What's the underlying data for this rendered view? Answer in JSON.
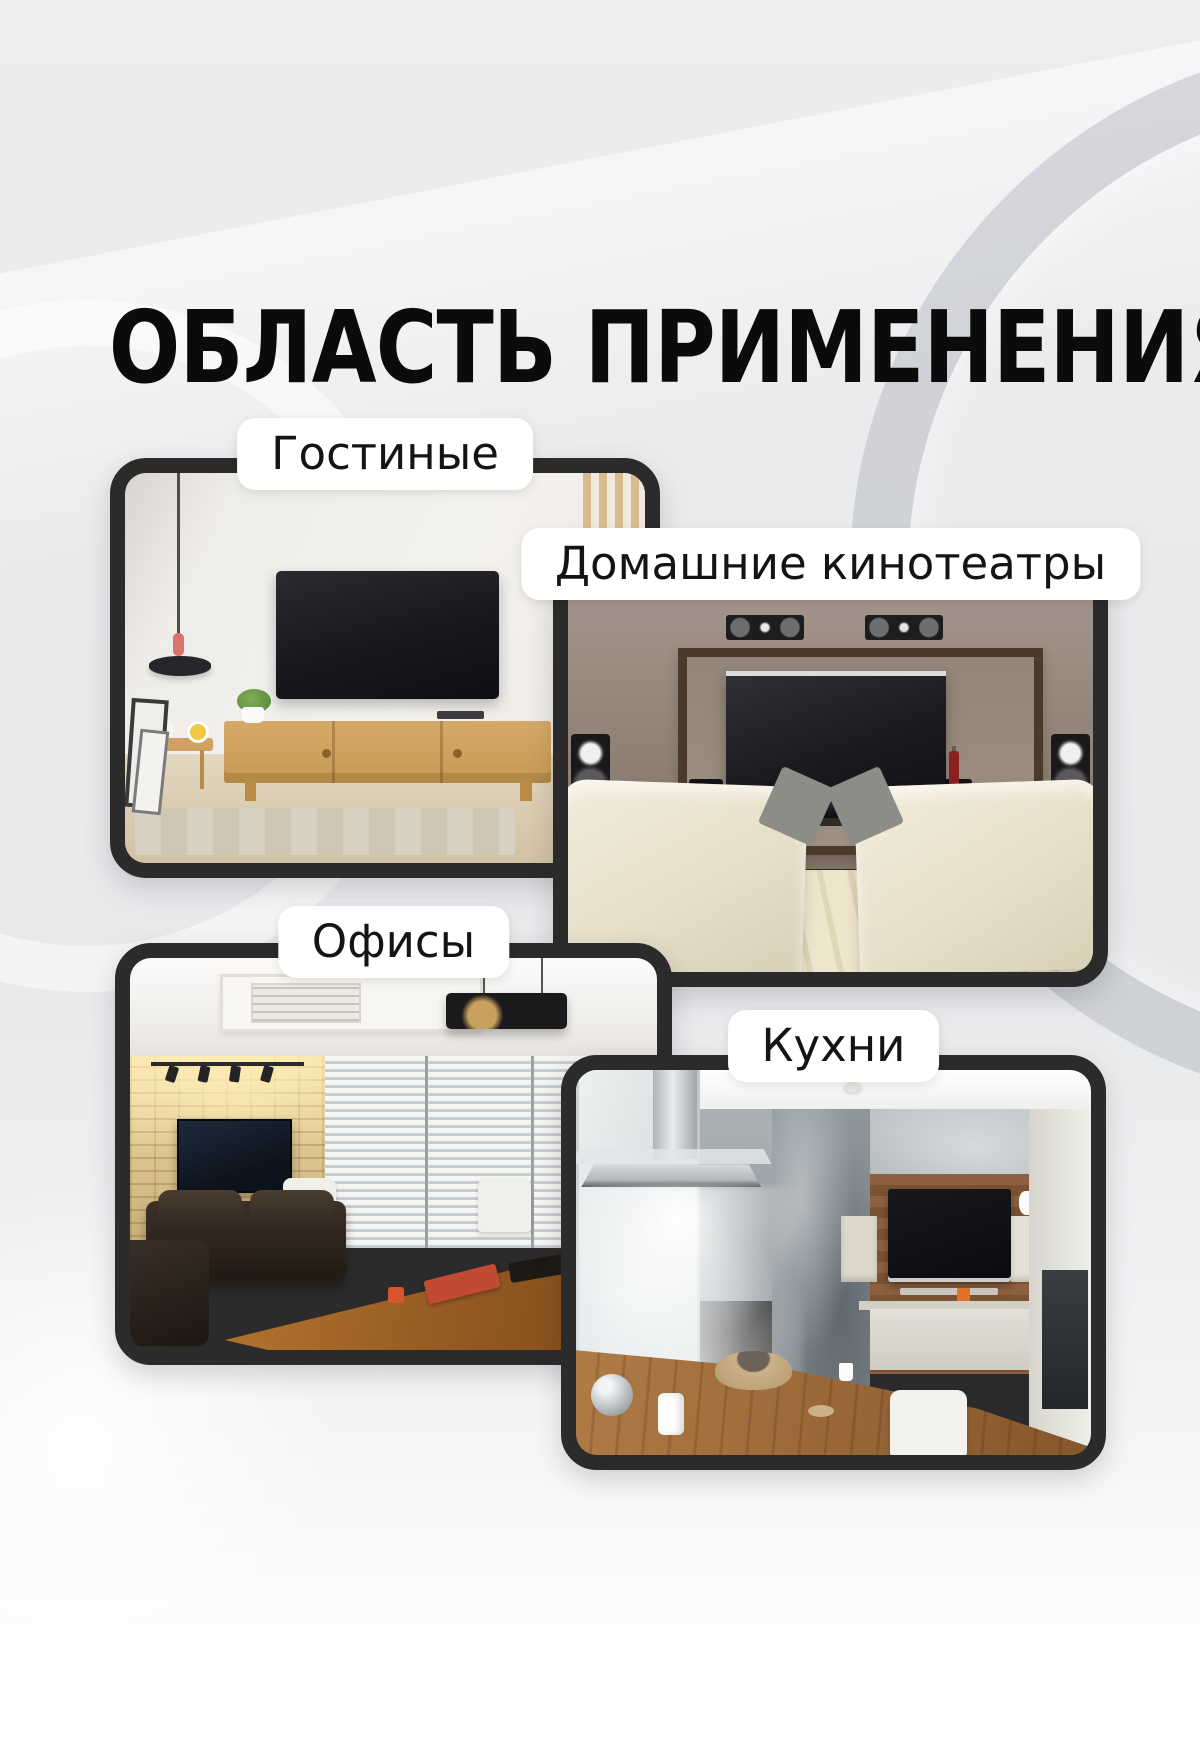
{
  "title": "ОБЛАСТЬ ПРИМЕНЕНИЯ",
  "cards": [
    {
      "id": "living-rooms",
      "label": "Гостиные",
      "scene": "living room with wall-mounted TV, wooden sideboard and pendant lamp"
    },
    {
      "id": "home-theaters",
      "label": "Домашние кинотеатры",
      "scene": "home theater with large screen, wall speakers and two cream armchairs"
    },
    {
      "id": "offices",
      "label": "Офисы",
      "scene": "office with TV on stone wall, window blinds, leather sofa and wooden meeting table"
    },
    {
      "id": "kitchens",
      "label": "Кухни",
      "scene": "kitchen with TV on wooden accent wall, range hood and wooden bar counter"
    }
  ],
  "colors": {
    "background": "#e9eaec",
    "photo_frame": "#2b2b2b",
    "label_background": "#ffffff",
    "label_text": "#141414",
    "title_text": "#0b0b0b"
  }
}
